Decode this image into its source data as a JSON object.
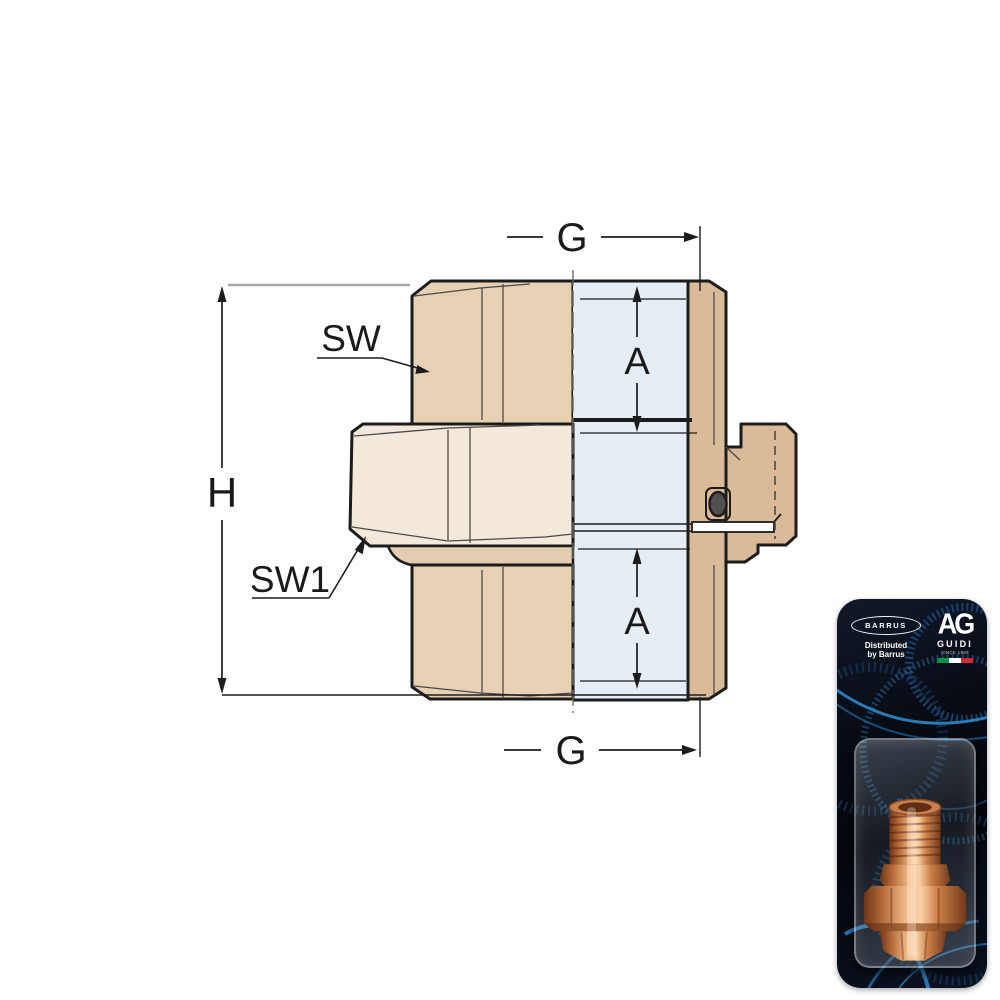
{
  "drawing": {
    "labels": {
      "g_top": "G",
      "g_bottom": "G",
      "a_top": "A",
      "a_bottom": "A",
      "h": "H",
      "sw": "SW",
      "sw1": "SW1"
    },
    "colors": {
      "body_tan": "#e8d0b5",
      "nut_cream": "#f2e9da",
      "section_tan": "#d9bb99",
      "bore_blue": "#e4eef4",
      "outline": "#1c1c1c",
      "oring_gray": "#4f4f4f"
    }
  },
  "packaging": {
    "distributor_logo": "BARRUS",
    "distributed_line1": "Distributed",
    "distributed_line2": "by Barrus",
    "maker_monogram": "AG",
    "maker_name": "GUIDI",
    "maker_tagline": "SINCE 1969",
    "flag": {
      "green": "#009246",
      "white": "#ffffff",
      "red": "#ce2b37"
    },
    "colors": {
      "card_bg": "#070b12",
      "accent_blue": "#2e86c8",
      "brass_light": "#f7c395",
      "brass_dark": "#7a3d1e"
    }
  }
}
